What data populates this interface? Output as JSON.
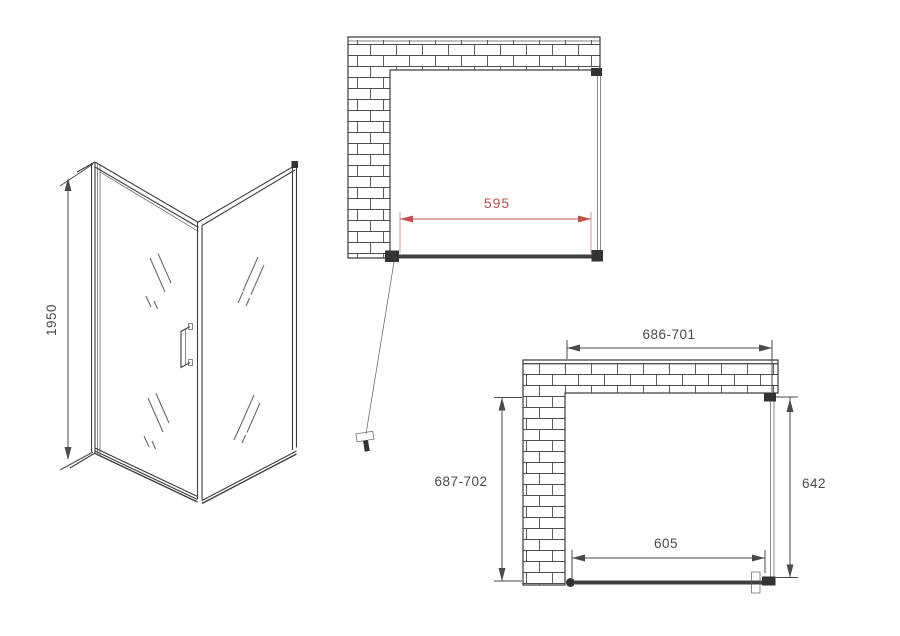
{
  "drawing_type": "shower-enclosure-technical-drawing",
  "colors": {
    "background": "#ffffff",
    "line": "#3d3d3d",
    "dimension_text": "#4a4a4a",
    "dimension_accent_red": "#c0504d"
  },
  "views": {
    "isometric": {
      "height_label": "1950"
    },
    "plan_top": {
      "width_label": "595"
    },
    "plan_bottom": {
      "top_width_label": "686-701",
      "left_depth_label": "687-702",
      "right_depth_label": "642",
      "bottom_width_label": "605"
    }
  }
}
